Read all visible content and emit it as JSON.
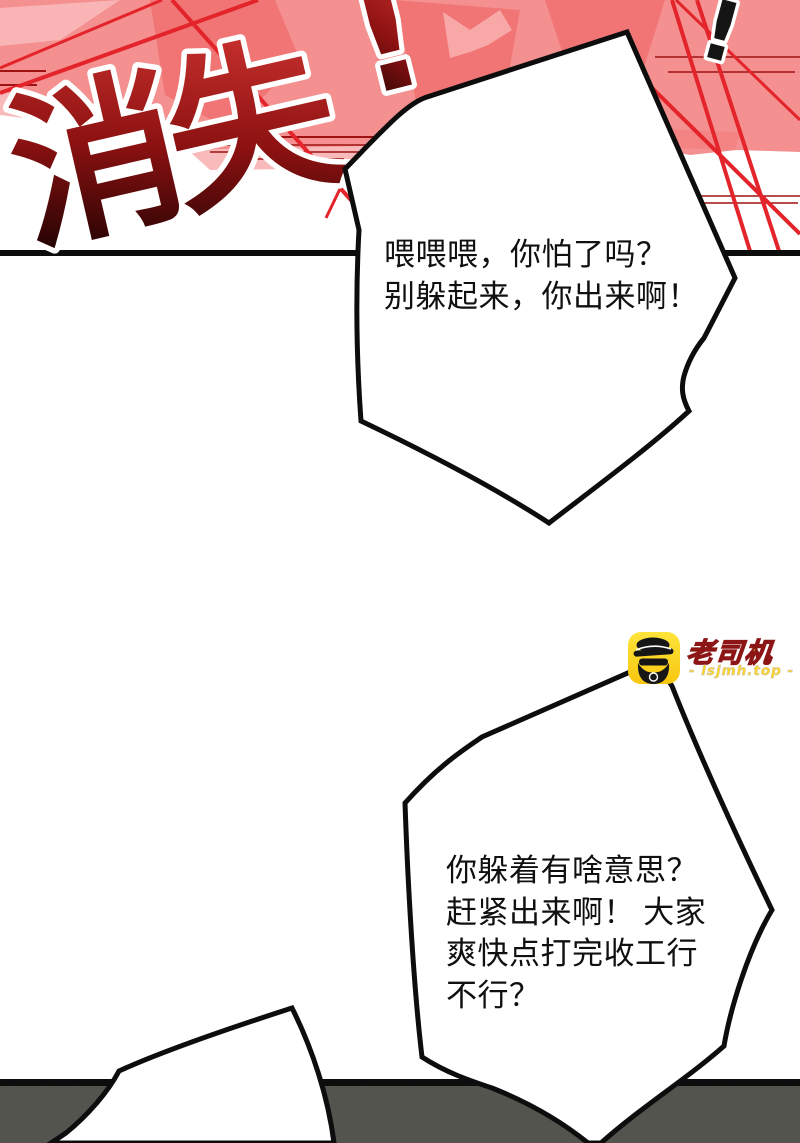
{
  "title": {
    "characters": "消失",
    "red_mark": "!",
    "black_mark": "!"
  },
  "speech": {
    "bubble1": {
      "lines": [
        "喂喂喂，你怕了吗？",
        "别躲起来，你出来啊！"
      ]
    },
    "bubble2": {
      "lines": [
        "你躲着有啥意思？",
        "赶紧出来啊！ 大家",
        "爽快点打完收工行",
        "不行？"
      ]
    },
    "bubble3": {
      "lines": []
    }
  },
  "watermark": {
    "name": "老司机",
    "site": "- lsjmh.top -"
  },
  "colors": {
    "background_pink": "#f59090",
    "light_pink": "#f8baba",
    "salmon": "#f17575",
    "accent_red": "#e3242b",
    "speedline_red": "#9e1212",
    "title_gradient_top": "#c6302d",
    "title_gradient_mid": "#8c1111",
    "title_gradient_bottom": "#1e0202",
    "outline_white": "#ffffff",
    "ink_black": "#0d0d0d",
    "ground_gray": "#76766f",
    "logo_yellow": "#ffd918"
  }
}
